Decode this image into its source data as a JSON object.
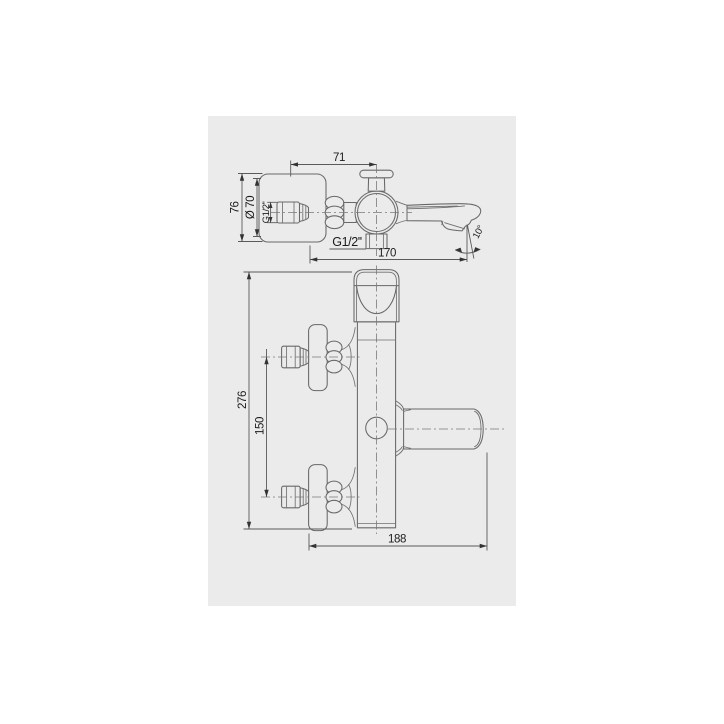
{
  "page": {
    "background": "#ffffff",
    "panel_background": "#ebebeb"
  },
  "drawing": {
    "subject": "wall-mounted bath mixer tap technical drawing",
    "views": [
      "top view",
      "front view"
    ],
    "line_color": "#686868",
    "dimension_color": "#5a5a5a",
    "text_color": "#1b1b1b"
  },
  "top_view": {
    "dim_center_offset": "71",
    "dim_plate_width": "76",
    "dim_plate_diameter": "Ø 70",
    "dim_inlet_thread": "G1/2''",
    "dim_outlet_thread": "G1/2''",
    "dim_spout_reach": "170",
    "dim_spout_angle": "10°"
  },
  "front_view": {
    "dim_overall_height": "276",
    "dim_inlet_spacing": "150",
    "dim_overall_depth": "188"
  }
}
